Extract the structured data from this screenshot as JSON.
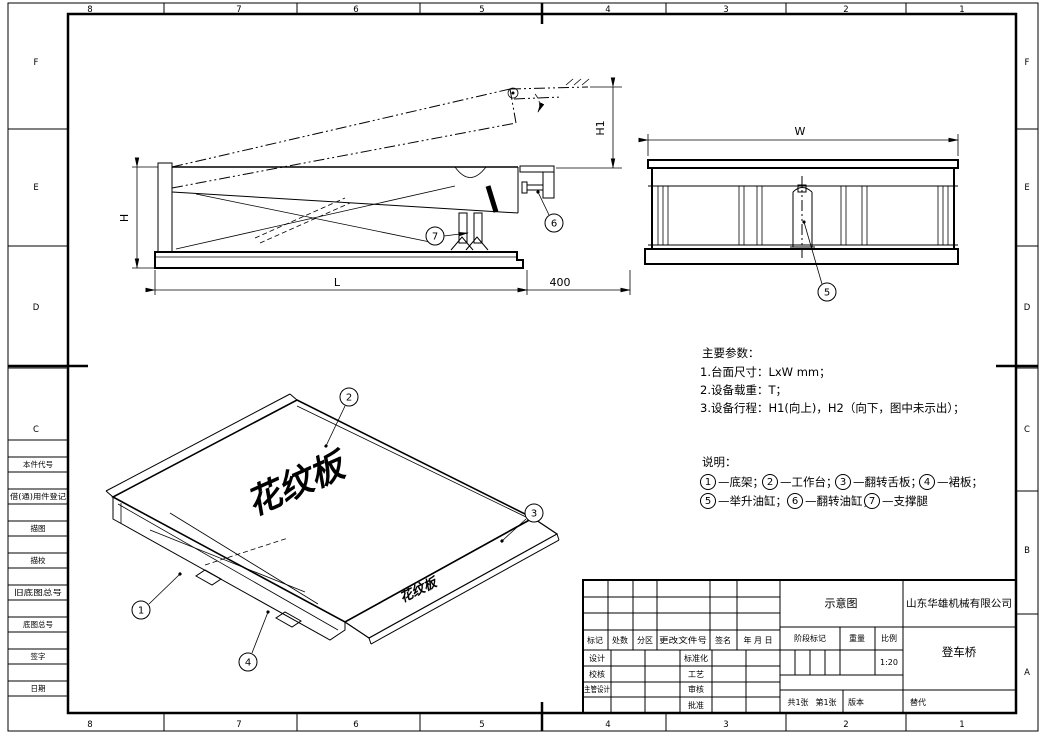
{
  "zones": {
    "top": [
      "8",
      "7",
      "6",
      "5",
      "4",
      "3",
      "2",
      "1"
    ],
    "bottom": [
      "8",
      "7",
      "6",
      "5",
      "4",
      "3",
      "2",
      "1"
    ],
    "left": [
      "F",
      "E",
      "D",
      "C"
    ],
    "right": [
      "F",
      "E",
      "D",
      "C",
      "B",
      "A"
    ]
  },
  "margin_blocks": [
    "本件代号",
    "借(通)用件登记",
    "描图",
    "描校",
    "旧底图总号",
    "底图总号",
    "签字",
    "日期"
  ],
  "views": {
    "side": {
      "dim_h": "H",
      "dim_h1": "H1",
      "dim_l": "L",
      "dim_lip": "400",
      "callout_support": "7",
      "callout_lip_cyl": "6"
    },
    "front": {
      "dim_w": "W",
      "callout_lift_cyl": "5"
    },
    "iso": {
      "callout_base": "1",
      "callout_platform": "2",
      "callout_lip": "3",
      "callout_skirt": "4",
      "plate_text_large": "花纹板",
      "plate_text_small": "花纹板"
    }
  },
  "notes": {
    "params_title": "主要参数：",
    "params": [
      "1.台面尺寸：LxW mm；",
      "2.设备载重：T；",
      "3.设备行程：H1(向上)，H2（向下，图中未示出）；"
    ],
    "legend_title": "说明：",
    "dash": "—",
    "sep": "；",
    "legend": [
      {
        "num": "1",
        "label": "底架"
      },
      {
        "num": "2",
        "label": "工作台"
      },
      {
        "num": "3",
        "label": "翻转舌板"
      },
      {
        "num": "4",
        "label": "裙板"
      },
      {
        "num": "5",
        "label": "举升油缸"
      },
      {
        "num": "6",
        "label": "翻转油缸"
      },
      {
        "num": "7",
        "label": "支撑腿"
      }
    ]
  },
  "title_block": {
    "revision_header": [
      "标记",
      "处数",
      "分区",
      "更改文件号",
      "签名",
      "年 月 日"
    ],
    "sign_rows": [
      {
        "left": "设计",
        "mid": "标准化"
      },
      {
        "left": "校核",
        "mid": "工艺"
      },
      {
        "left": "主管设计",
        "mid": "审核"
      },
      {
        "left": "",
        "mid": "批准"
      }
    ],
    "stage_label": "阶段标记",
    "weight_label": "重量",
    "scale_label": "比例",
    "scale_value": "1:20",
    "doc_type": "示意图",
    "company": "山东华雄机械有限公司",
    "drawing_title": "登车桥",
    "sheet_count": "共1张",
    "sheet_index": "第1张",
    "version_label": "版本",
    "replace_label": "替代"
  }
}
